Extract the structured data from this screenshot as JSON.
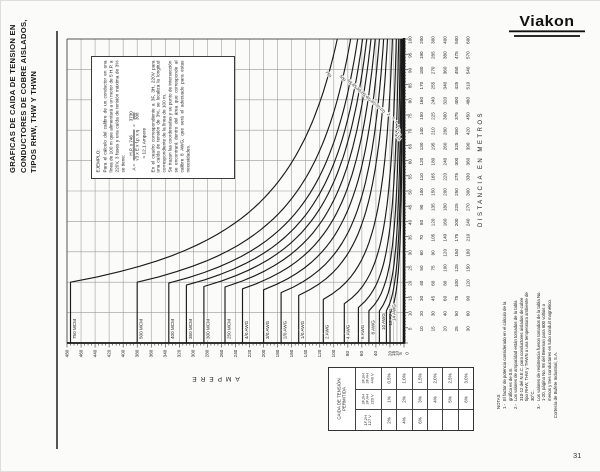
{
  "page": {
    "title_lines": [
      "GRAFICAS DE CAIDA DE TENSION EN",
      "CONDUCTORES DE COBRE AISLADOS,",
      "TIPOS RHW, THW Y THWN"
    ],
    "page_number": "31",
    "courtesy": "Cortesía de Bufete Industrial, S.A."
  },
  "logo": {
    "text": "Viakon"
  },
  "example_box": {
    "heading": "EJEMPLO:",
    "para1": "Para el cálculo del calibre de un conductor en una línea de 100 m que alimentará a un motor de 5 H.P. a 220V, 3 fases y una caída de tensión máxima de 3% se tiene:",
    "formula_lhs": "A =",
    "formula_num": "H.P. x 746",
    "formula_den": "√3 x E x f.p. x η",
    "equals": "=",
    "formula_eq_num": "3730",
    "formula_eq_den": "308",
    "formula_result": "= 12.1 Ampere",
    "para2": "En el cuadro correspondiente a 3F, 3H, 220V para una caída de tensión de 3%, se localiza la longitud correspondiente de la línea de 100 m.",
    "para3": "Se trazan las coordenadas y su punto de intersección se encontrará dentro del área que corresponde al calibre 8 AWG, que será el adecuado para estas necesidades."
  },
  "chart_data": {
    "type": "line",
    "title": "Gráfica de caída de tensión en conductores de cobre aislados",
    "orientation_note": "page printed rotated 90°: ampere axis horizontal (0 at right), distance axis vertical (0 at bottom)",
    "x_axis": {
      "label": "AMPERE",
      "range": [
        0,
        480
      ],
      "tick_labels": [
        480,
        460,
        440,
        420,
        400,
        380,
        360,
        340,
        320,
        300,
        280,
        260,
        240,
        220,
        200,
        180,
        160,
        140,
        120,
        100,
        80,
        60,
        40,
        20,
        15,
        10,
        5,
        0
      ]
    },
    "y_axis": {
      "label": "DISTANCIA EN METROS",
      "range": [
        0,
        100
      ],
      "tick_step": 5,
      "scale_multipliers": [
        1,
        2,
        3,
        4,
        5,
        6
      ],
      "note": "each tick shows 6 values: tick×1 … tick×6 (scales up to 600 m)"
    },
    "grid": {
      "ampere_step": 20,
      "ampere_extra": [
        5,
        10,
        15
      ],
      "distance_step": 10
    },
    "series": [
      {
        "name": "750 MCM",
        "short": "750",
        "ampacity": 475,
        "k": 9500
      },
      {
        "name": "500 MCM",
        "short": "500",
        "ampacity": 380,
        "k": 7600
      },
      {
        "name": "400 MCM",
        "short": "400",
        "ampacity": 335,
        "k": 6600
      },
      {
        "name": "350 MCM",
        "short": "350",
        "ampacity": 310,
        "k": 5900
      },
      {
        "name": "300 MCM",
        "short": "300",
        "ampacity": 285,
        "k": 5300
      },
      {
        "name": "250 MCM",
        "short": "250",
        "ampacity": 255,
        "k": 4700
      },
      {
        "name": "4/0 AWG",
        "short": "4/0",
        "ampacity": 230,
        "k": 4100
      },
      {
        "name": "3/0 AWG",
        "short": "3/0",
        "ampacity": 200,
        "k": 3500
      },
      {
        "name": "2/0 AWG",
        "short": "2/0",
        "ampacity": 175,
        "k": 2900
      },
      {
        "name": "1/0 AWG",
        "short": "1/0",
        "ampacity": 150,
        "k": 2350
      },
      {
        "name": "2 AWG",
        "short": "2",
        "ampacity": 115,
        "k": 1650
      },
      {
        "name": "4 AWG",
        "short": "4",
        "ampacity": 85,
        "k": 1100
      },
      {
        "name": "6 AWG",
        "short": "6",
        "ampacity": 65,
        "k": 760
      },
      {
        "name": "8 AWG",
        "short": "8",
        "ampacity": 50,
        "k": 530
      },
      {
        "name": "10 AWG",
        "short": "10",
        "ampacity": 35,
        "k": 370
      },
      {
        "name": "12 AWG",
        "short": "12",
        "ampacity": 25,
        "k": 265
      },
      {
        "name": "14 AWG",
        "short": "14",
        "ampacity": 20,
        "k": 190
      }
    ],
    "curve_rule": "A(L) = min(ampacity, k / L)"
  },
  "permitted_drop_table": {
    "header": "CAIDA DE TENSIÓN|PERMITIDA",
    "rows": [
      {
        "system": [
          "3F,3H",
          "3F,4H",
          "440 V"
        ],
        "values": [
          "0.5%",
          "1.0%",
          "1.5%",
          "2.0%",
          "2.5%",
          "3.0%"
        ]
      },
      {
        "system": [
          "3F,3H",
          "3F,4H",
          "220 V"
        ],
        "values": [
          "1%",
          "2%",
          "3%",
          "4%",
          "5%",
          "6%"
        ]
      },
      {
        "system": [
          "1F,2H",
          "127 V"
        ],
        "values": [
          "2%",
          "4%",
          "6%",
          "",
          "",
          ""
        ]
      }
    ]
  },
  "notes": {
    "heading": "NOTAS",
    "items": [
      {
        "num": "1.-",
        "text": "El factor de potencia considerado en el cálculo de la gráfica es de 0.8."
      },
      {
        "num": "2.-",
        "text": "Los valores de ampacidad están tomados de la tabla 310-12 del N.E.C. para conductores aislados de cobre tipo RHW, THW y THWN a una temperatura ambiente de 30°C."
      },
      {
        "num": "3.-",
        "text": "Los valores de resistencia fueron tomados de la tabla No. 1-20, página No. 98 del Beeman para 600 voltios o menos y tres conductores en tubo conduit magnético."
      }
    ]
  }
}
